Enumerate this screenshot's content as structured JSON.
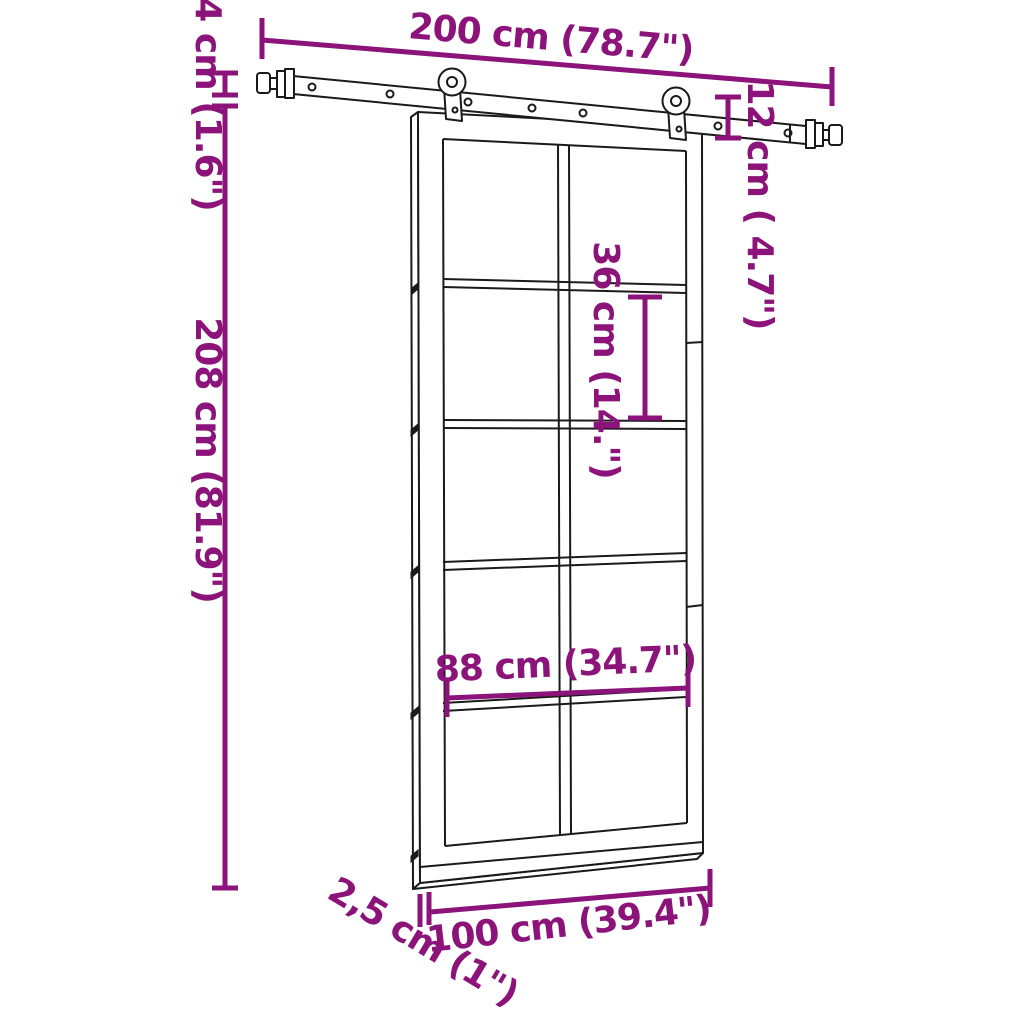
{
  "colors": {
    "dimension_accent": "#8b1379",
    "line_art": "#1a1a1a",
    "background": "#ffffff"
  },
  "diagram": {
    "kind": "sliding-door-dimension-diagram",
    "labels": {
      "rail_length": "200 cm (78.7\")",
      "rail_offset_height": "4 cm (1.6\")",
      "total_height": "208 cm (81.9\")",
      "hanger_drop": "12 cm ( 4.7\")",
      "pane_height": "36 cm (14.\")",
      "inner_width": "88 cm (34.7\")",
      "door_width": "100 cm (39.4\")",
      "door_thickness": "2,5 cm (1\")"
    }
  }
}
